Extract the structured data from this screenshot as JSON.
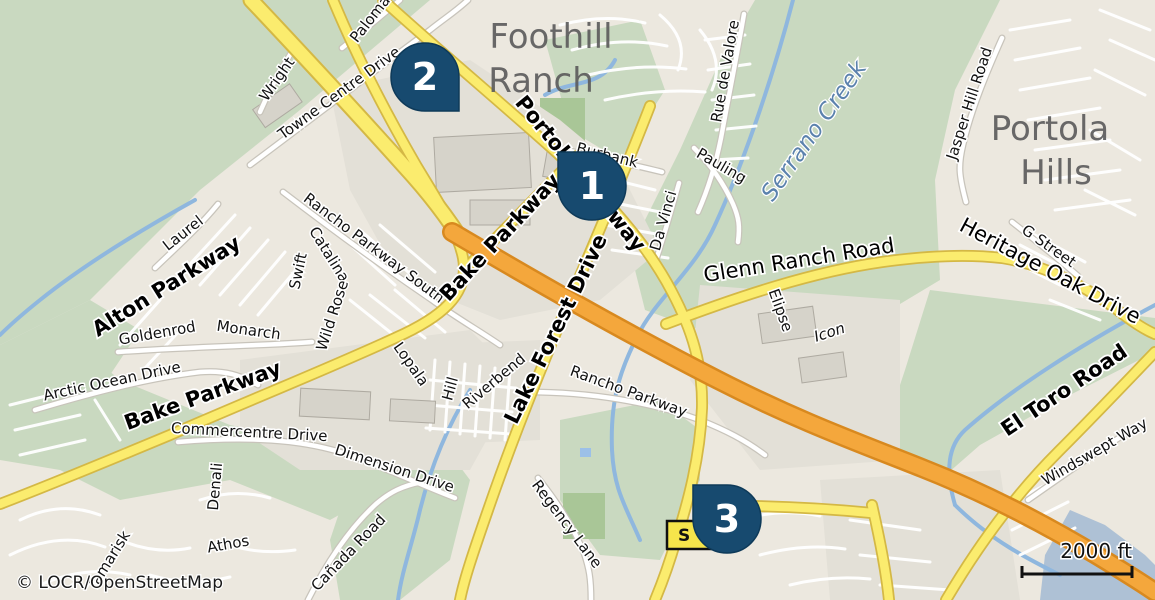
{
  "map": {
    "attribution": "© LOCR/OpenStreetMap",
    "scale_bar": {
      "label": "2000 ft"
    },
    "shield": {
      "text": "S"
    },
    "markers": [
      {
        "label": "1"
      },
      {
        "label": "2"
      },
      {
        "label": "3"
      }
    ],
    "labels": {
      "places": [
        {
          "text": "Foothill"
        },
        {
          "text": "Ranch"
        },
        {
          "text": "Portola"
        },
        {
          "text": "Hills"
        }
      ],
      "water": [
        {
          "text": "Serrano Creek"
        }
      ],
      "roads": [
        {
          "text": "Alton Parkway"
        },
        {
          "text": "Bake Parkway"
        },
        {
          "text": "Portola Parkway"
        },
        {
          "text": "Lake Forest Drive"
        },
        {
          "text": "El Toro Road"
        },
        {
          "text": "Bake Parkway"
        },
        {
          "text": "Glenn Ranch Road"
        },
        {
          "text": "Heritage Oak Drive"
        }
      ],
      "streets": [
        {
          "text": "Wright"
        },
        {
          "text": "Towne Centre Drive"
        },
        {
          "text": "Paloma"
        },
        {
          "text": "Burbank"
        },
        {
          "text": "Pauling"
        },
        {
          "text": "Rue de Valore"
        },
        {
          "text": "Da Vinci"
        },
        {
          "text": "Jasper Hill Road"
        },
        {
          "text": "G Street"
        },
        {
          "text": "Elipse"
        },
        {
          "text": "Icon"
        },
        {
          "text": "Rancho Parkway South"
        },
        {
          "text": "Rancho Parkway"
        },
        {
          "text": "Laurel"
        },
        {
          "text": "Catalina"
        },
        {
          "text": "Swift"
        },
        {
          "text": "Wild Rose"
        },
        {
          "text": "Monarch"
        },
        {
          "text": "Goldenrod"
        },
        {
          "text": "Arctic Ocean Drive"
        },
        {
          "text": "Commercentre Drive"
        },
        {
          "text": "Dimension Drive"
        },
        {
          "text": "Denali"
        },
        {
          "text": "Athos"
        },
        {
          "text": "Tamarisk"
        },
        {
          "text": "Cañada Road"
        },
        {
          "text": "Regency Lane"
        },
        {
          "text": "Hill"
        },
        {
          "text": "Riverbend"
        },
        {
          "text": "Lopala"
        },
        {
          "text": "Windswept Way"
        }
      ]
    },
    "colors": {
      "marker": "#174a6f",
      "land": "#ece8df",
      "green": "#c9d9c0",
      "water": "#aec1d5",
      "road_yellow": "#fbec6e",
      "motorway_orange": "#f4a73c",
      "city_label": "#5d5d5d",
      "water_label": "#5b82ad",
      "shield_yellow": "#f6e54b"
    }
  }
}
